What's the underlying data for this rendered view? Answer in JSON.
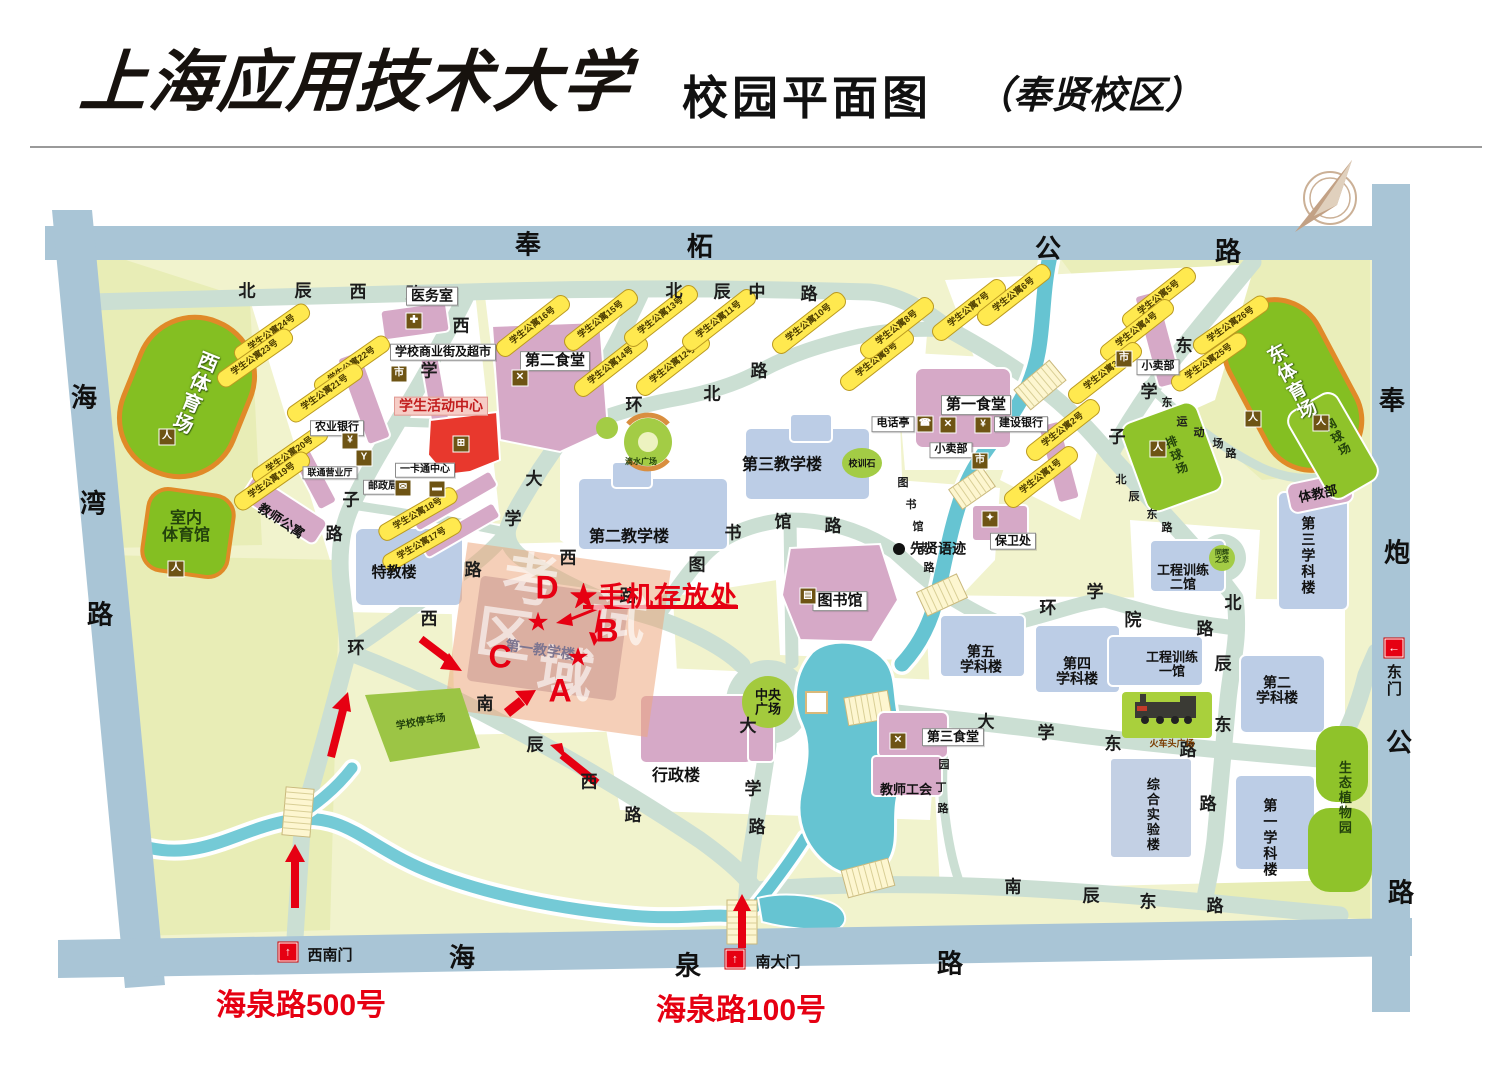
{
  "header": {
    "university": "上海应用技术大学",
    "map_title": "校园平面图",
    "campus": "（奉贤校区）"
  },
  "legend": {
    "phone_storage": "★手机存放处",
    "sw_address": "海泉路500号",
    "s_address": "海泉路100号"
  },
  "map": {
    "outer_road_chars": [
      {
        "c": "奉",
        "x": 528,
        "y": 243
      },
      {
        "c": "柘",
        "x": 700,
        "y": 245
      },
      {
        "c": "公",
        "x": 1048,
        "y": 247
      },
      {
        "c": "路",
        "x": 1228,
        "y": 250
      },
      {
        "c": "海",
        "x": 84,
        "y": 396
      },
      {
        "c": "湾",
        "x": 93,
        "y": 502
      },
      {
        "c": "路",
        "x": 100,
        "y": 613
      },
      {
        "c": "奉",
        "x": 1392,
        "y": 399
      },
      {
        "c": "炮",
        "x": 1397,
        "y": 551
      },
      {
        "c": "公",
        "x": 1399,
        "y": 741
      },
      {
        "c": "路",
        "x": 1401,
        "y": 891
      },
      {
        "c": "海",
        "x": 462,
        "y": 956
      },
      {
        "c": "泉",
        "x": 688,
        "y": 964
      },
      {
        "c": "路",
        "x": 950,
        "y": 962
      }
    ],
    "road_chars": [
      {
        "c": "北",
        "x": 247,
        "y": 289
      },
      {
        "c": "辰",
        "x": 303,
        "y": 289
      },
      {
        "c": "西",
        "x": 358,
        "y": 290
      },
      {
        "c": "路",
        "x": 414,
        "y": 292
      },
      {
        "c": "北",
        "x": 674,
        "y": 289
      },
      {
        "c": "辰",
        "x": 722,
        "y": 290
      },
      {
        "c": "中",
        "x": 757,
        "y": 290
      },
      {
        "c": "路",
        "x": 809,
        "y": 292
      },
      {
        "c": "环",
        "x": 634,
        "y": 403
      },
      {
        "c": "北",
        "x": 712,
        "y": 392
      },
      {
        "c": "路",
        "x": 759,
        "y": 369
      },
      {
        "c": "西",
        "x": 461,
        "y": 324
      },
      {
        "c": "学",
        "x": 429,
        "y": 369
      },
      {
        "c": "子",
        "x": 351,
        "y": 498
      },
      {
        "c": "路",
        "x": 334,
        "y": 532
      },
      {
        "c": "东",
        "x": 1184,
        "y": 344
      },
      {
        "c": "学",
        "x": 1149,
        "y": 390
      },
      {
        "c": "子",
        "x": 1117,
        "y": 435
      },
      {
        "c": "北",
        "x": 1233,
        "y": 601
      },
      {
        "c": "辰",
        "x": 1223,
        "y": 662
      },
      {
        "c": "东",
        "x": 1223,
        "y": 723
      },
      {
        "c": "路",
        "x": 1208,
        "y": 802
      },
      {
        "c": "环",
        "x": 1048,
        "y": 606
      },
      {
        "c": "学",
        "x": 1095,
        "y": 590
      },
      {
        "c": "院",
        "x": 1133,
        "y": 618
      },
      {
        "c": "路",
        "x": 1205,
        "y": 627
      },
      {
        "c": "大",
        "x": 534,
        "y": 477
      },
      {
        "c": "学",
        "x": 513,
        "y": 517
      },
      {
        "c": "西",
        "x": 568,
        "y": 556
      },
      {
        "c": "路",
        "x": 628,
        "y": 594
      },
      {
        "c": "大",
        "x": 748,
        "y": 724
      },
      {
        "c": "学",
        "x": 753,
        "y": 787
      },
      {
        "c": "路",
        "x": 757,
        "y": 825
      },
      {
        "c": "大",
        "x": 986,
        "y": 720
      },
      {
        "c": "学",
        "x": 1046,
        "y": 731
      },
      {
        "c": "东",
        "x": 1113,
        "y": 742
      },
      {
        "c": "路",
        "x": 1188,
        "y": 748
      },
      {
        "c": "南",
        "x": 485,
        "y": 702
      },
      {
        "c": "辰",
        "x": 535,
        "y": 743
      },
      {
        "c": "西",
        "x": 589,
        "y": 780
      },
      {
        "c": "路",
        "x": 633,
        "y": 813
      },
      {
        "c": "南",
        "x": 1013,
        "y": 885
      },
      {
        "c": "辰",
        "x": 1091,
        "y": 894
      },
      {
        "c": "东",
        "x": 1148,
        "y": 900
      },
      {
        "c": "路",
        "x": 1215,
        "y": 904
      },
      {
        "c": "环",
        "x": 356,
        "y": 646
      },
      {
        "c": "西",
        "x": 429,
        "y": 617
      },
      {
        "c": "路",
        "x": 473,
        "y": 568
      },
      {
        "c": "图",
        "x": 697,
        "y": 563
      },
      {
        "c": "书",
        "x": 733,
        "y": 531
      },
      {
        "c": "馆",
        "x": 783,
        "y": 520
      },
      {
        "c": "路",
        "x": 833,
        "y": 524
      }
    ],
    "minor_road_chars": [
      {
        "c": "北",
        "x": 1121,
        "y": 479
      },
      {
        "c": "辰",
        "x": 1134,
        "y": 496
      },
      {
        "c": "东",
        "x": 1152,
        "y": 514
      },
      {
        "c": "路",
        "x": 1167,
        "y": 527
      },
      {
        "c": "图",
        "x": 903,
        "y": 482
      },
      {
        "c": "书",
        "x": 911,
        "y": 504
      },
      {
        "c": "馆",
        "x": 918,
        "y": 526
      },
      {
        "c": "支",
        "x": 923,
        "y": 547
      },
      {
        "c": "路",
        "x": 929,
        "y": 567
      },
      {
        "c": "园",
        "x": 944,
        "y": 764
      },
      {
        "c": "丁",
        "x": 941,
        "y": 787
      },
      {
        "c": "路",
        "x": 943,
        "y": 808
      },
      {
        "c": "东",
        "x": 1167,
        "y": 402
      },
      {
        "c": "运",
        "x": 1182,
        "y": 421
      },
      {
        "c": "动",
        "x": 1199,
        "y": 432
      },
      {
        "c": "场",
        "x": 1218,
        "y": 443
      },
      {
        "c": "路",
        "x": 1231,
        "y": 453
      }
    ],
    "labels": [
      {
        "t": "医务室",
        "x": 432,
        "y": 296,
        "fs": 14,
        "cls": "box"
      },
      {
        "t": "学校商业街及超市",
        "x": 443,
        "y": 352,
        "fs": 12,
        "cls": "box"
      },
      {
        "t": "第二食堂",
        "x": 555,
        "y": 361,
        "fs": 15,
        "cls": "box"
      },
      {
        "t": "学生活动中心",
        "x": 441,
        "y": 406,
        "fs": 14,
        "cls": "pinkbox"
      },
      {
        "t": "农业银行",
        "x": 337,
        "y": 428,
        "fs": 11,
        "cls": "box"
      },
      {
        "t": "联通营业厅",
        "x": 330,
        "y": 473,
        "fs": 9,
        "cls": "box"
      },
      {
        "t": "一卡通中心",
        "x": 425,
        "y": 470,
        "fs": 10,
        "cls": "box"
      },
      {
        "t": "邮政局",
        "x": 383,
        "y": 487,
        "fs": 10,
        "cls": "box"
      },
      {
        "t": "教师公寓",
        "x": 281,
        "y": 521,
        "fs": 13,
        "cls": "plain",
        "rot": 33
      },
      {
        "t": "特教楼",
        "x": 394,
        "y": 573,
        "fs": 15,
        "cls": "plain"
      },
      {
        "t": "室内\n体育馆",
        "x": 186,
        "y": 528,
        "fs": 16,
        "cls": "plain dk"
      },
      {
        "t": "西体育场",
        "x": 193,
        "y": 392,
        "fs": 20,
        "cls": "v white",
        "rot": 22
      },
      {
        "t": "东体育场",
        "x": 1290,
        "y": 383,
        "fs": 19,
        "cls": "v white",
        "rot": -28
      },
      {
        "t": "网球场",
        "x": 1337,
        "y": 438,
        "fs": 12,
        "cls": "v dk",
        "rot": -30
      },
      {
        "t": "排球场",
        "x": 1176,
        "y": 456,
        "fs": 12,
        "cls": "v dk",
        "rot": -22
      },
      {
        "t": "体教部",
        "x": 1318,
        "y": 494,
        "fs": 13,
        "cls": "plain",
        "rot": -12
      },
      {
        "t": "学校停车场",
        "x": 421,
        "y": 723,
        "fs": 10,
        "cls": "plain dk",
        "rot": -10
      },
      {
        "t": "滴水广场",
        "x": 641,
        "y": 462,
        "fs": 8,
        "cls": "plain dk"
      },
      {
        "t": "校训石",
        "x": 862,
        "y": 464,
        "fs": 9,
        "cls": "plain"
      },
      {
        "t": "同辉\n之恋",
        "x": 1222,
        "y": 557,
        "fs": 7,
        "cls": "plain dk"
      },
      {
        "t": "中央\n广场",
        "x": 768,
        "y": 702,
        "fs": 13,
        "cls": "plain"
      },
      {
        "t": "第三教学楼",
        "x": 782,
        "y": 466,
        "fs": 16,
        "cls": "plain"
      },
      {
        "t": "第二教学楼",
        "x": 629,
        "y": 538,
        "fs": 16,
        "cls": "plain"
      },
      {
        "t": "第一教学楼",
        "x": 540,
        "y": 650,
        "fs": 14,
        "cls": "plain gray",
        "rot": 8
      },
      {
        "t": "行政楼",
        "x": 676,
        "y": 777,
        "fs": 16,
        "cls": "plain"
      },
      {
        "t": "图书馆",
        "x": 840,
        "y": 601,
        "fs": 15,
        "cls": "box"
      },
      {
        "t": "保卫处",
        "x": 1013,
        "y": 541,
        "fs": 12,
        "cls": "box"
      },
      {
        "t": "先贤语迹",
        "x": 938,
        "y": 549,
        "fs": 14,
        "cls": "plain"
      },
      {
        "t": "电话亭",
        "x": 893,
        "y": 424,
        "fs": 11,
        "cls": "box"
      },
      {
        "t": "建设银行",
        "x": 1021,
        "y": 424,
        "fs": 11,
        "cls": "box"
      },
      {
        "t": "第一食堂",
        "x": 976,
        "y": 405,
        "fs": 15,
        "cls": "box"
      },
      {
        "t": "小卖部",
        "x": 1158,
        "y": 367,
        "fs": 11,
        "cls": "box"
      },
      {
        "t": "小卖部",
        "x": 951,
        "y": 450,
        "fs": 11,
        "cls": "box"
      },
      {
        "t": "第三食堂",
        "x": 953,
        "y": 737,
        "fs": 13,
        "cls": "box"
      },
      {
        "t": "教师工会",
        "x": 906,
        "y": 790,
        "fs": 13,
        "cls": "plain"
      },
      {
        "t": "第五\n学科楼",
        "x": 981,
        "y": 659,
        "fs": 14,
        "cls": "plain"
      },
      {
        "t": "第四\n学科楼",
        "x": 1077,
        "y": 671,
        "fs": 14,
        "cls": "plain"
      },
      {
        "t": "工程训练\n二馆",
        "x": 1183,
        "y": 577,
        "fs": 13,
        "cls": "plain"
      },
      {
        "t": "工程训练\n一馆",
        "x": 1172,
        "y": 664,
        "fs": 13,
        "cls": "plain"
      },
      {
        "t": "第三学科楼",
        "x": 1308,
        "y": 556,
        "fs": 14,
        "cls": "v"
      },
      {
        "t": "第二\n学科楼",
        "x": 1277,
        "y": 690,
        "fs": 14,
        "cls": "plain"
      },
      {
        "t": "第一学科楼",
        "x": 1270,
        "y": 838,
        "fs": 14,
        "cls": "v"
      },
      {
        "t": "综合实验楼",
        "x": 1152,
        "y": 815,
        "fs": 13,
        "cls": "v"
      },
      {
        "t": "生态植物园",
        "x": 1344,
        "y": 798,
        "fs": 13,
        "cls": "v dk"
      },
      {
        "t": "火车头广场",
        "x": 1172,
        "y": 744,
        "fs": 9,
        "cls": "plain",
        "color": "#7a3c00"
      },
      {
        "t": "考",
        "x": 530,
        "y": 582,
        "fs": 56,
        "cls": "wm",
        "rot": 8
      },
      {
        "t": "试",
        "x": 618,
        "y": 620,
        "fs": 56,
        "cls": "wm",
        "rot": 8
      },
      {
        "t": "区",
        "x": 504,
        "y": 636,
        "fs": 56,
        "cls": "wm",
        "rot": 8
      },
      {
        "t": "域",
        "x": 565,
        "y": 676,
        "fs": 56,
        "cls": "wm",
        "rot": 8
      }
    ],
    "dorms": [
      {
        "t": "学生公寓24号",
        "x": 272,
        "y": 333,
        "rot": -35
      },
      {
        "t": "学生公寓23号",
        "x": 255,
        "y": 358,
        "rot": -35
      },
      {
        "t": "学生公寓22号",
        "x": 352,
        "y": 365,
        "rot": -35
      },
      {
        "t": "学生公寓21号",
        "x": 325,
        "y": 393,
        "rot": -35
      },
      {
        "t": "学生公寓20号",
        "x": 290,
        "y": 455,
        "rot": -35
      },
      {
        "t": "学生公寓19号",
        "x": 272,
        "y": 481,
        "rot": -35
      },
      {
        "t": "学生公寓18号",
        "x": 418,
        "y": 514,
        "rot": -30
      },
      {
        "t": "学生公寓17号",
        "x": 422,
        "y": 544,
        "rot": -30
      },
      {
        "t": "学生公寓16号",
        "x": 533,
        "y": 326,
        "rot": -38
      },
      {
        "t": "学生公寓15号",
        "x": 601,
        "y": 320,
        "rot": -38
      },
      {
        "t": "学生公寓14号",
        "x": 611,
        "y": 366,
        "rot": -38
      },
      {
        "t": "学生公寓13号",
        "x": 661,
        "y": 316,
        "rot": -38
      },
      {
        "t": "学生公寓12号",
        "x": 673,
        "y": 365,
        "rot": -38
      },
      {
        "t": "学生公寓11号",
        "x": 719,
        "y": 320,
        "rot": -38
      },
      {
        "t": "学生公寓10号",
        "x": 809,
        "y": 323,
        "rot": -38
      },
      {
        "t": "学生公寓9号",
        "x": 877,
        "y": 360,
        "rot": -38
      },
      {
        "t": "学生公寓8号",
        "x": 897,
        "y": 328,
        "rot": -38
      },
      {
        "t": "学生公寓7号",
        "x": 969,
        "y": 310,
        "rot": -38
      },
      {
        "t": "学生公寓6号",
        "x": 1014,
        "y": 295,
        "rot": -38
      },
      {
        "t": "学生公寓5号",
        "x": 1159,
        "y": 298,
        "rot": -38
      },
      {
        "t": "学生公寓4号",
        "x": 1137,
        "y": 330,
        "rot": -38
      },
      {
        "t": "学生公寓3号",
        "x": 1105,
        "y": 373,
        "rot": -38
      },
      {
        "t": "学生公寓2号",
        "x": 1063,
        "y": 430,
        "rot": -38
      },
      {
        "t": "学生公寓1号",
        "x": 1041,
        "y": 477,
        "rot": -38
      },
      {
        "t": "学生公寓26号",
        "x": 1231,
        "y": 325,
        "rot": -35
      },
      {
        "t": "学生公寓25号",
        "x": 1209,
        "y": 362,
        "rot": -35
      }
    ],
    "icons": [
      {
        "type": "medical",
        "x": 414,
        "y": 321
      },
      {
        "type": "cart",
        "x": 399,
        "y": 374
      },
      {
        "type": "dining",
        "x": 520,
        "y": 378
      },
      {
        "type": "activity",
        "x": 461,
        "y": 444
      },
      {
        "type": "bank",
        "x": 350,
        "y": 441
      },
      {
        "type": "signal",
        "x": 364,
        "y": 458
      },
      {
        "type": "postal",
        "x": 403,
        "y": 488
      },
      {
        "type": "card",
        "x": 437,
        "y": 489
      },
      {
        "type": "phone",
        "x": 925,
        "y": 424
      },
      {
        "type": "dining",
        "x": 948,
        "y": 425
      },
      {
        "type": "bank",
        "x": 983,
        "y": 425
      },
      {
        "type": "cart",
        "x": 1124,
        "y": 359
      },
      {
        "type": "cart",
        "x": 980,
        "y": 461
      },
      {
        "type": "dining",
        "x": 898,
        "y": 741
      },
      {
        "type": "security",
        "x": 990,
        "y": 519
      },
      {
        "type": "book",
        "x": 808,
        "y": 596
      },
      {
        "type": "runner",
        "x": 167,
        "y": 437
      },
      {
        "type": "runner",
        "x": 176,
        "y": 569
      },
      {
        "type": "runner",
        "x": 1253,
        "y": 419
      },
      {
        "type": "runner",
        "x": 1321,
        "y": 423
      },
      {
        "type": "runner",
        "x": 1158,
        "y": 449
      }
    ],
    "icon_glyphs": {
      "medical": "✚",
      "cart": "市",
      "dining": "✕",
      "activity": "⊞",
      "bank": "¥",
      "signal": "Y",
      "postal": "✉",
      "card": "▬",
      "phone": "☎",
      "security": "✦",
      "book": "▤",
      "runner": "人"
    },
    "gates": [
      {
        "t": "西南门",
        "x": 288,
        "y": 952,
        "lx": 330,
        "ly": 956,
        "arrow": "↑",
        "vertical": false
      },
      {
        "t": "南大门",
        "x": 735,
        "y": 959,
        "lx": 778,
        "ly": 963,
        "arrow": "↑",
        "vertical": false
      },
      {
        "t": "东门",
        "x": 1394,
        "y": 648,
        "lx": 1393,
        "ly": 681,
        "arrow": "←",
        "vertical": true
      }
    ],
    "letters": [
      {
        "t": "D",
        "x": 547,
        "y": 588
      },
      {
        "t": "B",
        "x": 607,
        "y": 631
      },
      {
        "t": "C",
        "x": 500,
        "y": 657
      },
      {
        "t": "A",
        "x": 560,
        "y": 691
      }
    ],
    "stars": [
      {
        "x": 538,
        "y": 622
      },
      {
        "x": 578,
        "y": 657
      }
    ]
  }
}
